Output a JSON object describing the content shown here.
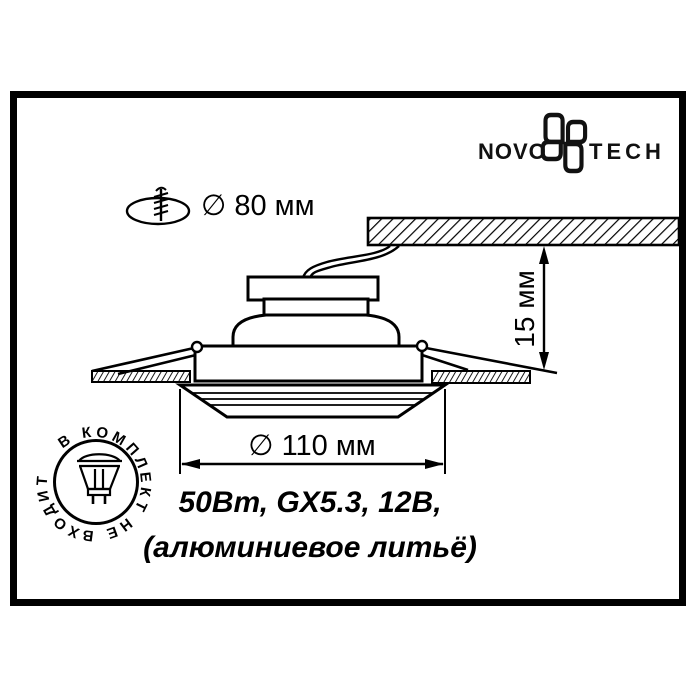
{
  "frame": {
    "border_color": "#000000",
    "background": "#ffffff",
    "line_color": "#000000"
  },
  "logo": {
    "name_left": "NOVO",
    "name_right": "TECH"
  },
  "cutout_note": {
    "diameter_label": "∅ 80 мм"
  },
  "dimensions": {
    "recess_depth": "15 мм",
    "outer_diameter": "∅ 110 мм"
  },
  "specs": {
    "line1": "50Вт, GX5.3, 12В,",
    "line2": "(алюминиевое литьё)"
  },
  "stamp": {
    "circular_text": "В КОМПЛЕКТ НЕ ВХОДИТ"
  },
  "icons": {
    "logo_icon": "novotech-flower-icon",
    "cutout_icon": "drill-hole-icon",
    "stamp_icon": "mr16-lamp-icon"
  }
}
